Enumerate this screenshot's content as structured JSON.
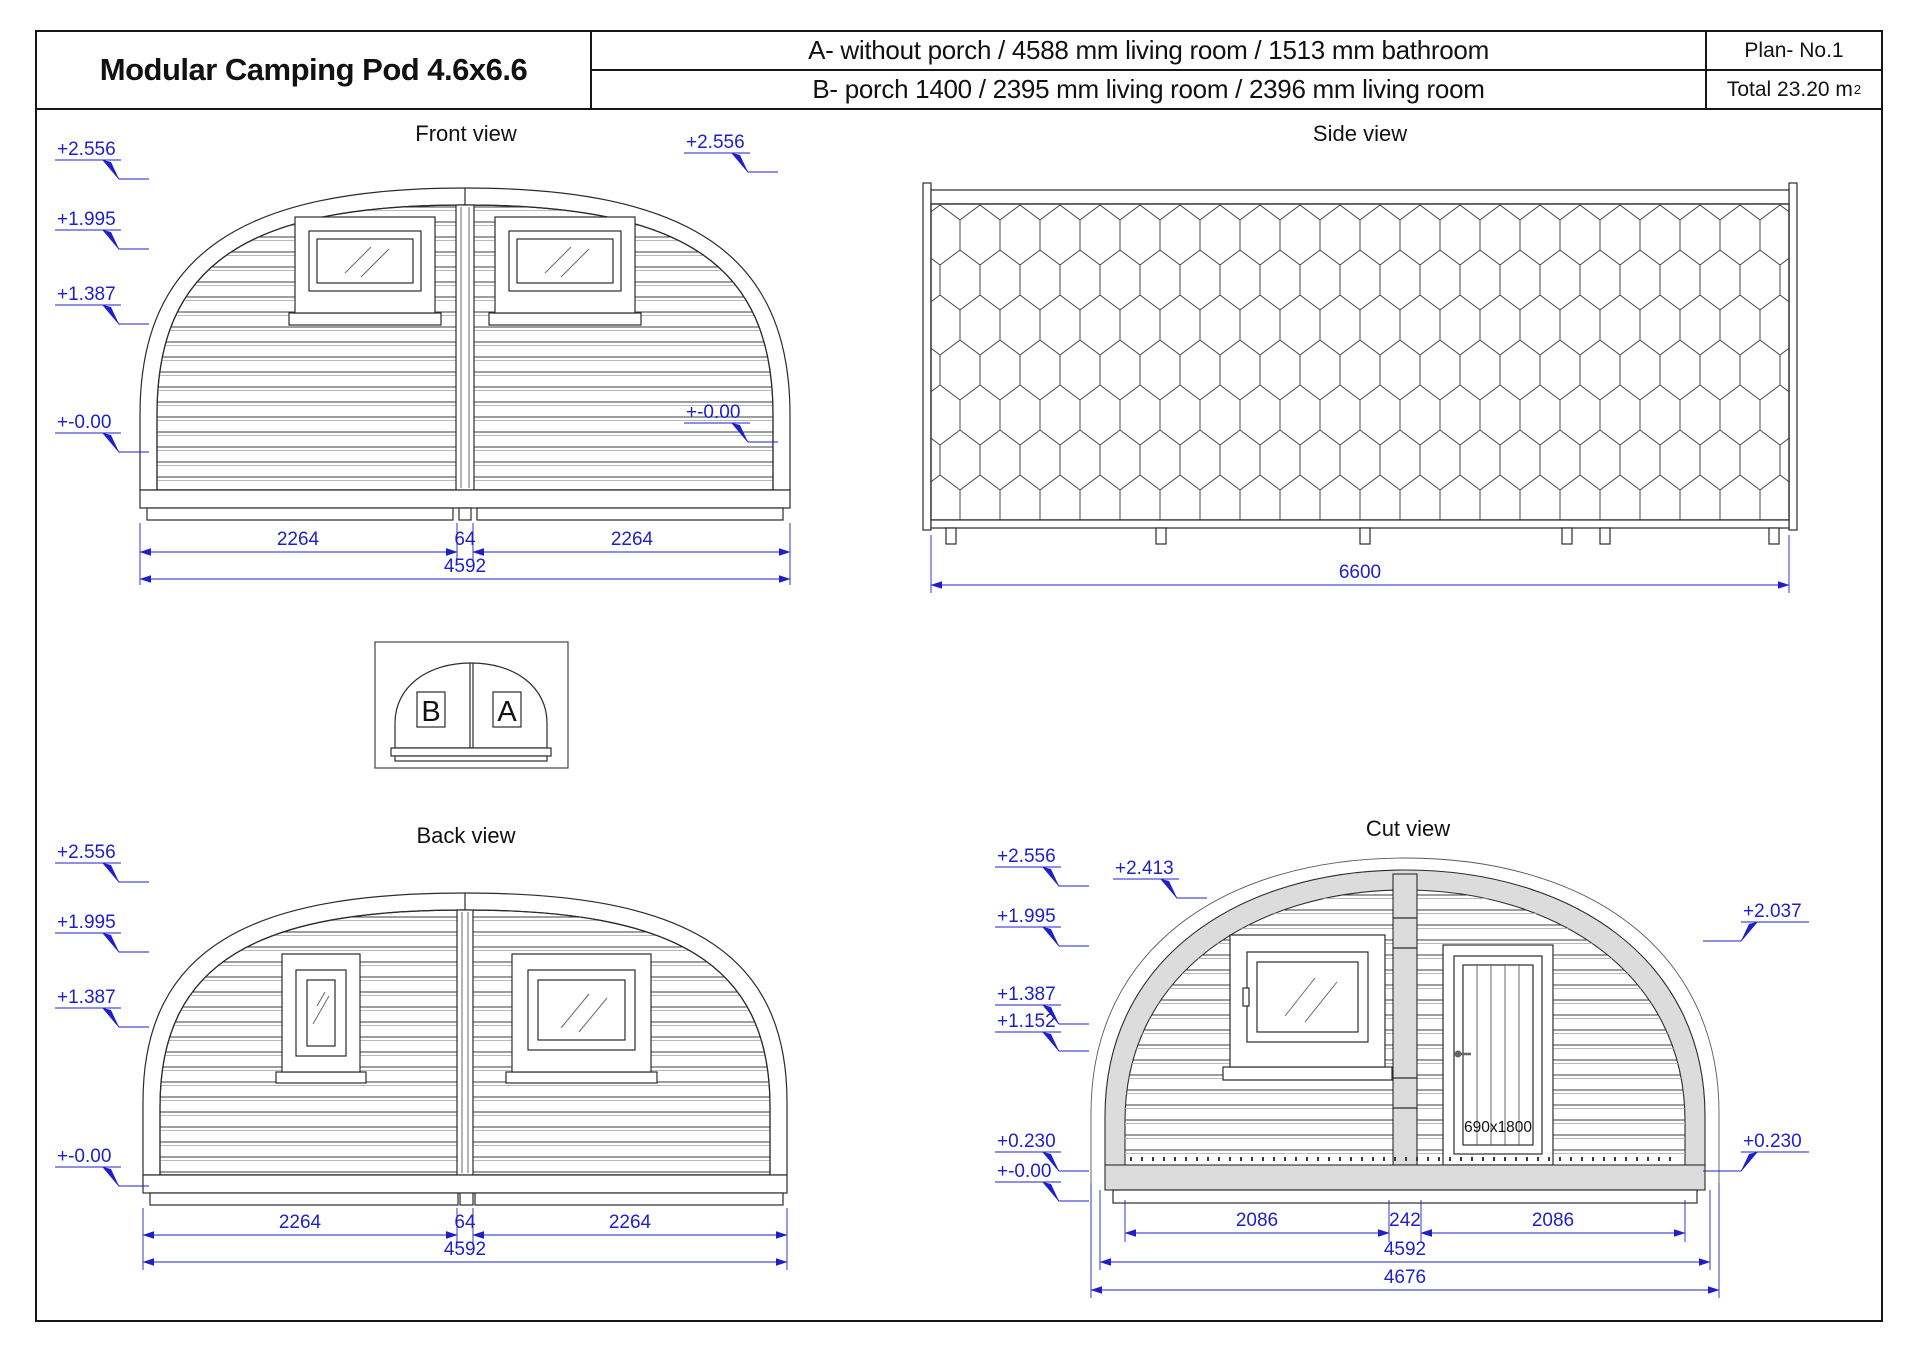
{
  "header": {
    "title": "Modular Camping Pod 4.6x6.6",
    "row_a": "A- without porch / 4588 mm living room / 1513 mm bathroom",
    "row_b": "B-  porch 1400 / 2395 mm living room / 2396 mm living room",
    "plan_no": "Plan- No.1",
    "total": "Total  23.20 m",
    "total_sup": "2"
  },
  "front_view": {
    "title": "Front view",
    "elev": [
      "+2.556",
      "+1.995",
      "+1.387",
      "+-0.00"
    ],
    "dim_left": "2264",
    "dim_mid": "64",
    "dim_right": "2264",
    "dim_total": "4592"
  },
  "side_view": {
    "title": "Side view",
    "elev_top": "+2.556",
    "elev_bottom": "+-0.00",
    "dim_total": "6600"
  },
  "key_diagram": {
    "left": "B",
    "right": "A"
  },
  "back_view": {
    "title": "Back view",
    "elev": [
      "+2.556",
      "+1.995",
      "+1.387",
      "+-0.00"
    ],
    "dim_left": "2264",
    "dim_mid": "64",
    "dim_right": "2264",
    "dim_total": "4592"
  },
  "cut_view": {
    "title": "Cut view",
    "elev_left": [
      "+2.556",
      "+2.413",
      "+1.995",
      "+1.387",
      "+1.152",
      "+0.230",
      "+-0.00"
    ],
    "elev_right": [
      "+2.037",
      "+0.230"
    ],
    "door_label": "690x1800",
    "dim_left": "2086",
    "dim_mid": "242",
    "dim_right": "2086",
    "dim_total": "4592",
    "dim_overall": "4676"
  },
  "colors": {
    "dim_blue": "#1f1fc8",
    "line": "#2b2b2b",
    "shell_gray": "#dcdcdc"
  }
}
